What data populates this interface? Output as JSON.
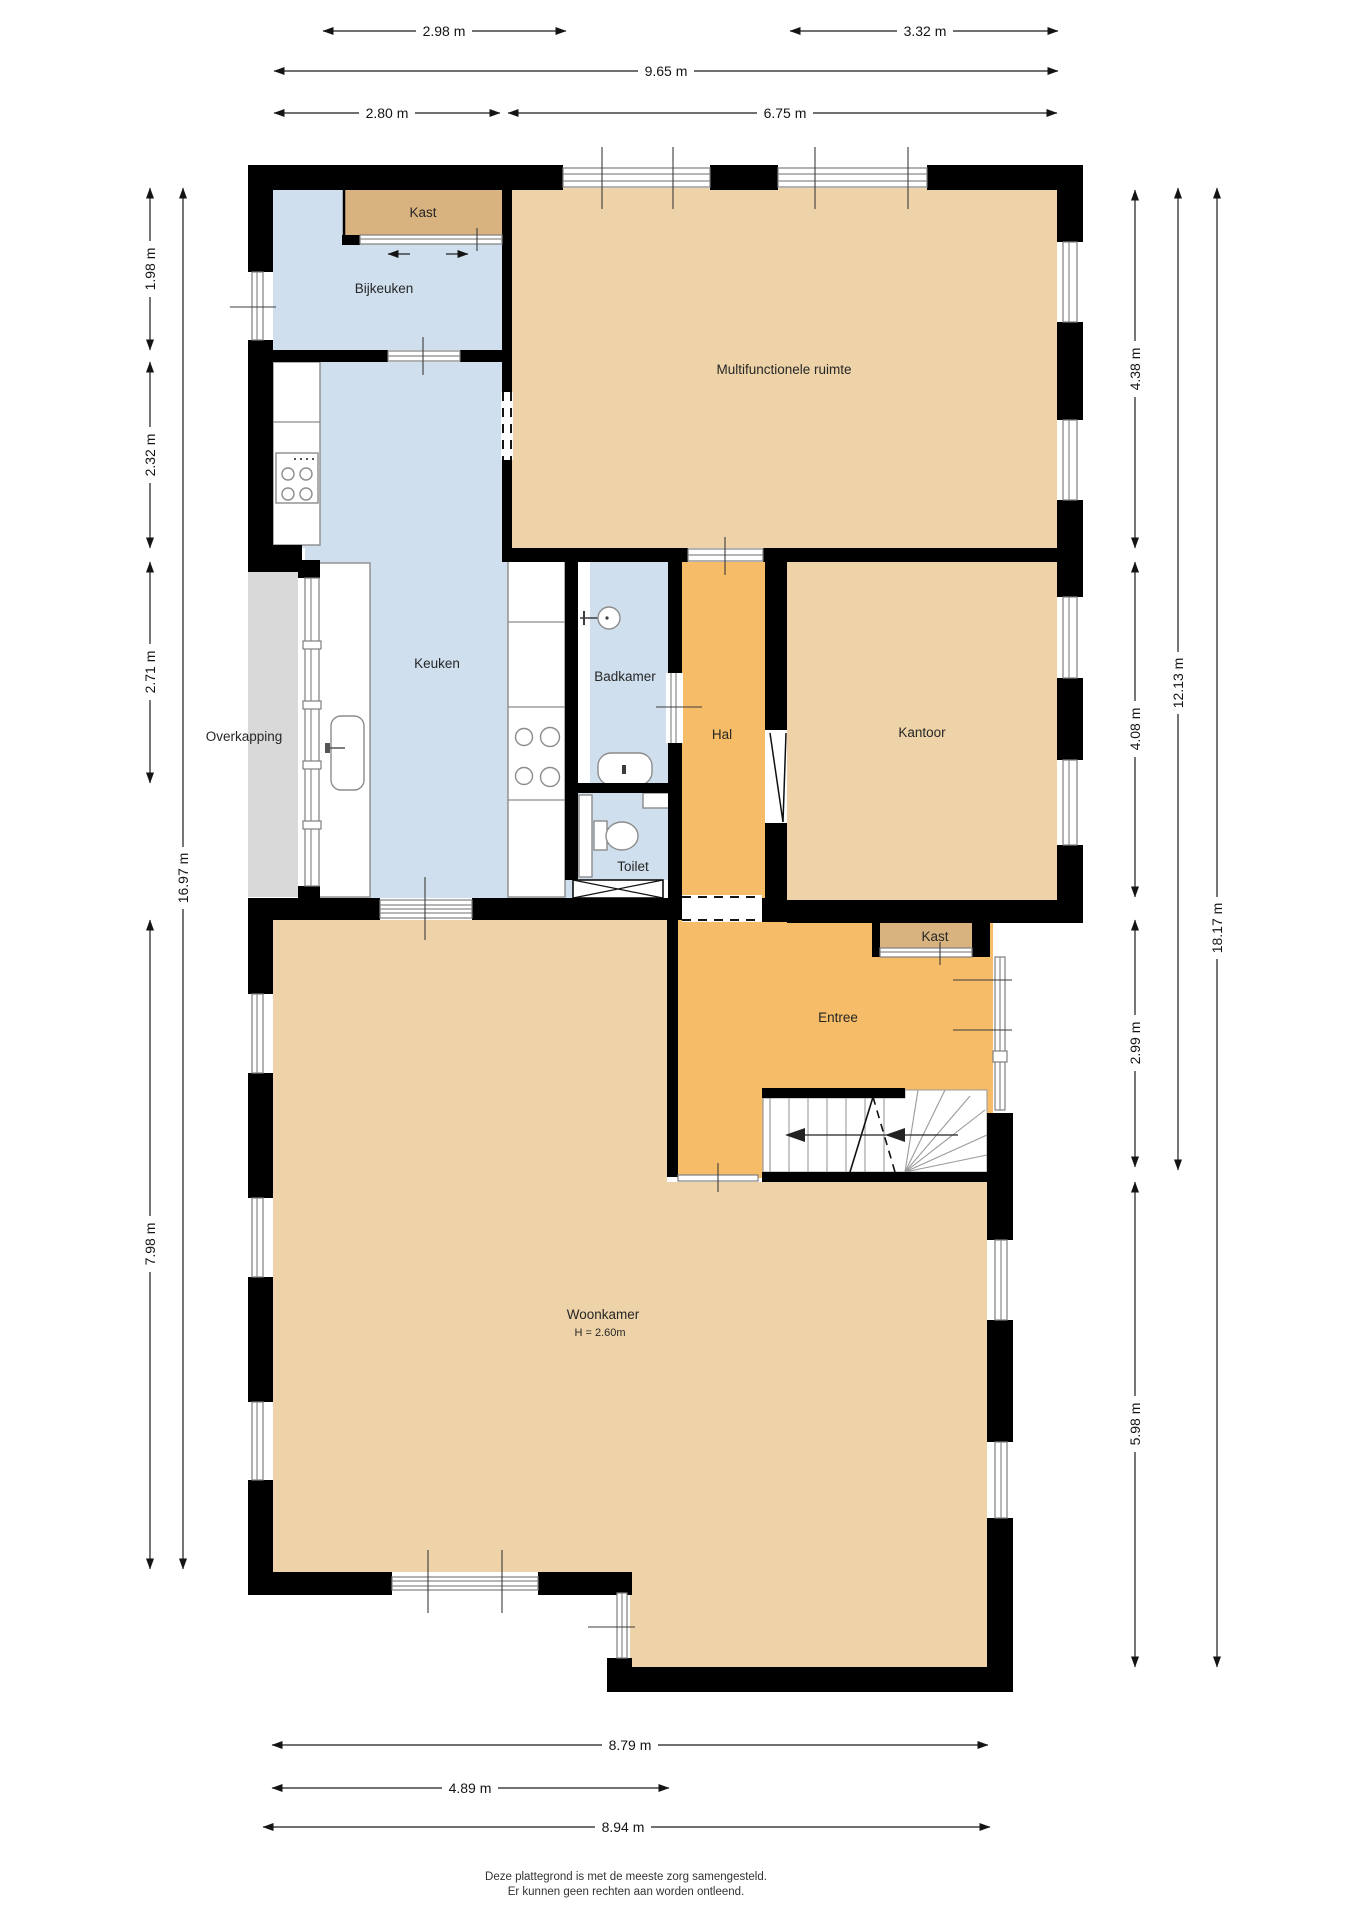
{
  "plan_type": "floorplan",
  "colors": {
    "wall": "#000000",
    "room_tan": "#eed3a8",
    "room_orange": "#f6bc67",
    "room_blue": "#cfdfee",
    "closet_tan": "#d8b27f",
    "overkapping_gray": "#d9d9d9",
    "window_line": "#8a8a8a",
    "text": "#262626"
  },
  "rooms": [
    {
      "id": "kast-boven",
      "label": "Kast"
    },
    {
      "id": "bijkeuken",
      "label": "Bijkeuken"
    },
    {
      "id": "multifunctionele-ruimte",
      "label": "Multifunctionele ruimte"
    },
    {
      "id": "keuken",
      "label": "Keuken"
    },
    {
      "id": "badkamer",
      "label": "Badkamer"
    },
    {
      "id": "hal",
      "label": "Hal"
    },
    {
      "id": "kantoor",
      "label": "Kantoor"
    },
    {
      "id": "overkapping",
      "label": "Overkapping"
    },
    {
      "id": "toilet",
      "label": "Toilet"
    },
    {
      "id": "kast-entree",
      "label": "Kast"
    },
    {
      "id": "entree",
      "label": "Entree"
    },
    {
      "id": "woonkamer",
      "label": "Woonkamer",
      "sublabel": "H = 2.60m"
    }
  ],
  "dimensions": {
    "top": [
      {
        "label": "2.98 m"
      },
      {
        "label": "3.32 m"
      },
      {
        "label": "9.65 m"
      },
      {
        "label": "2.80 m"
      },
      {
        "label": "6.75 m"
      }
    ],
    "left": [
      {
        "label": "1.98 m"
      },
      {
        "label": "2.32 m"
      },
      {
        "label": "2.71 m"
      },
      {
        "label": "7.98 m"
      },
      {
        "label": "16.97 m"
      }
    ],
    "right": [
      {
        "label": "4.38 m"
      },
      {
        "label": "4.08 m"
      },
      {
        "label": "2.99 m"
      },
      {
        "label": "5.98 m"
      },
      {
        "label": "12.13 m"
      },
      {
        "label": "18.17 m"
      }
    ],
    "bottom": [
      {
        "label": "8.79 m"
      },
      {
        "label": "4.89 m"
      },
      {
        "label": "8.94 m"
      }
    ]
  },
  "footer": {
    "line1": "Deze plattegrond is met de meeste zorg samengesteld.",
    "line2": "Er kunnen geen rechten aan worden ontleend."
  }
}
